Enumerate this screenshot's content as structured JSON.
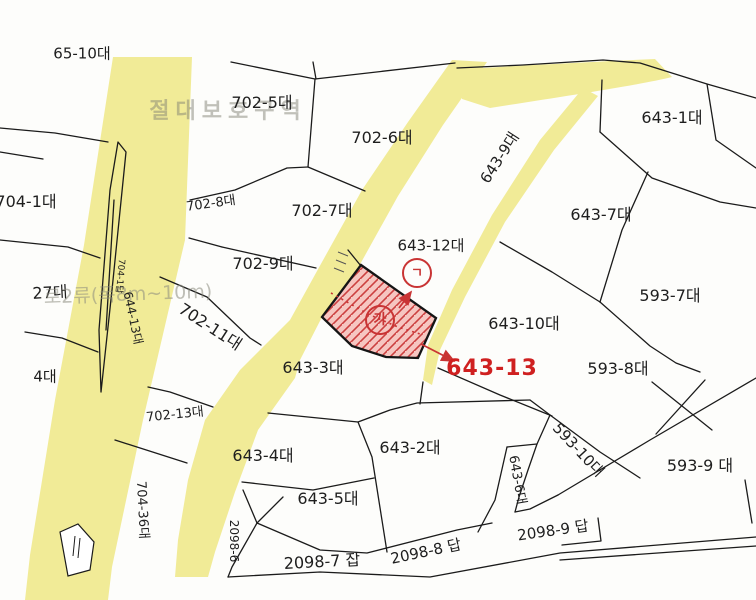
{
  "meta": {
    "title": "cadastral-parcel-map",
    "colors": {
      "road_yellow": "#f1eb97",
      "boundary_black": "#1b1b1b",
      "highlight_red": "#c93434",
      "highlight_parcel_fill": "#f5c0ba",
      "faint_text": "#8a8a7d"
    },
    "highlighted_parcel_number": "643-13"
  },
  "map": {
    "labels": [
      {
        "name": "parcel-label-65-10",
        "text": "65-10대",
        "x": 82,
        "y": 54,
        "s": 15,
        "r": 0
      },
      {
        "name": "protection-zone-label",
        "text": "절대보호구역",
        "x": 228,
        "y": 112,
        "s": 22,
        "r": 0,
        "cls": "faint",
        "ls": 6
      },
      {
        "name": "parcel-label-702-5",
        "text": "702-5대",
        "x": 262,
        "y": 103,
        "s": 16,
        "r": 0
      },
      {
        "name": "parcel-label-702-6",
        "text": "702-6대",
        "x": 382,
        "y": 138,
        "s": 16,
        "r": 0
      },
      {
        "name": "parcel-label-643-9",
        "text": "643-9대",
        "x": 500,
        "y": 158,
        "s": 15,
        "r": -57
      },
      {
        "name": "parcel-label-643-1",
        "text": "643-1대",
        "x": 672,
        "y": 118,
        "s": 16,
        "r": 0
      },
      {
        "name": "parcel-label-704-1",
        "text": "704-1대",
        "x": 26,
        "y": 202,
        "s": 16,
        "r": 0
      },
      {
        "name": "parcel-label-702-8",
        "text": "702-8대",
        "x": 211,
        "y": 204,
        "s": 13,
        "r": -8
      },
      {
        "name": "parcel-label-702-7",
        "text": "702-7대",
        "x": 322,
        "y": 211,
        "s": 16,
        "r": 0
      },
      {
        "name": "parcel-label-643-7",
        "text": "643-7대",
        "x": 601,
        "y": 215,
        "s": 16,
        "r": 0
      },
      {
        "name": "parcel-label-643-12",
        "text": "643-12대",
        "x": 431,
        "y": 246,
        "s": 15,
        "r": 0
      },
      {
        "name": "parcel-label-702-9",
        "text": "702-9대",
        "x": 263,
        "y": 264,
        "s": 16,
        "r": 0
      },
      {
        "name": "parcel-label-27",
        "text": "27대",
        "x": 50,
        "y": 293,
        "s": 16,
        "r": -3
      },
      {
        "name": "road-class-label",
        "text": "로2류(폭8m~10m)",
        "x": 128,
        "y": 295,
        "s": 19,
        "r": -2,
        "cls": "faint2"
      },
      {
        "name": "parcel-label-704-1b",
        "text": "704-1답",
        "x": 119,
        "y": 276,
        "s": 9,
        "r": 95
      },
      {
        "name": "parcel-label-644-13",
        "text": "644-13대",
        "x": 133,
        "y": 318,
        "s": 12,
        "r": 78
      },
      {
        "name": "parcel-label-702-11",
        "text": "702-11대",
        "x": 210,
        "y": 327,
        "s": 16,
        "r": 33
      },
      {
        "name": "parcel-label-593-7",
        "text": "593-7대",
        "x": 670,
        "y": 296,
        "s": 16,
        "r": 0
      },
      {
        "name": "parcel-label-643-10",
        "text": "643-10대",
        "x": 524,
        "y": 324,
        "s": 16,
        "r": 0
      },
      {
        "name": "parcel-label-643-3",
        "text": "643-3대",
        "x": 313,
        "y": 368,
        "s": 16,
        "r": 0
      },
      {
        "name": "parcel-label-593-8",
        "text": "593-8대",
        "x": 618,
        "y": 369,
        "s": 16,
        "r": 0
      },
      {
        "name": "parcel-label-4",
        "text": "4대",
        "x": 45,
        "y": 377,
        "s": 15,
        "r": 0
      },
      {
        "name": "parcel-label-702-13",
        "text": "702-13대",
        "x": 175,
        "y": 415,
        "s": 13,
        "r": -6
      },
      {
        "name": "parcel-label-643-2",
        "text": "643-2대",
        "x": 410,
        "y": 448,
        "s": 16,
        "r": 0
      },
      {
        "name": "parcel-label-593-10",
        "text": "593-10대",
        "x": 578,
        "y": 450,
        "s": 15,
        "r": 47
      },
      {
        "name": "parcel-label-643-4",
        "text": "643-4대",
        "x": 263,
        "y": 456,
        "s": 16,
        "r": 0
      },
      {
        "name": "parcel-label-593-9",
        "text": "593-9 대",
        "x": 700,
        "y": 466,
        "s": 16,
        "r": 0
      },
      {
        "name": "parcel-label-643-5",
        "text": "643-5대",
        "x": 328,
        "y": 499,
        "s": 16,
        "r": 0
      },
      {
        "name": "parcel-label-643-6",
        "text": "643-6대",
        "x": 517,
        "y": 480,
        "s": 13,
        "r": 80
      },
      {
        "name": "parcel-label-704-36",
        "text": "704-36대",
        "x": 142,
        "y": 510,
        "s": 13,
        "r": 87
      },
      {
        "name": "parcel-label-2098-6",
        "text": "2098-6",
        "x": 234,
        "y": 541,
        "s": 12,
        "r": 90
      },
      {
        "name": "parcel-label-2098-9",
        "text": "2098-9 답",
        "x": 553,
        "y": 531,
        "s": 15,
        "r": -8
      },
      {
        "name": "parcel-label-2098-8",
        "text": "2098-8 답",
        "x": 426,
        "y": 552,
        "s": 15,
        "r": -12
      },
      {
        "name": "parcel-label-2098-7",
        "text": "2098-7 잡",
        "x": 322,
        "y": 562,
        "s": 16,
        "r": -3
      },
      {
        "name": "highlight-parcel-number",
        "text": "643-13",
        "x": 492,
        "y": 369,
        "s": 22,
        "r": 0,
        "cls": "red-label"
      },
      {
        "name": "circled-ga-marker",
        "text": "가",
        "x": 380,
        "y": 320,
        "s": 14,
        "r": 0,
        "cls": "circled"
      },
      {
        "name": "circled-giyeok-marker",
        "text": "ㄱ",
        "x": 417,
        "y": 273,
        "s": 13,
        "r": 0,
        "cls": "circled"
      }
    ]
  }
}
